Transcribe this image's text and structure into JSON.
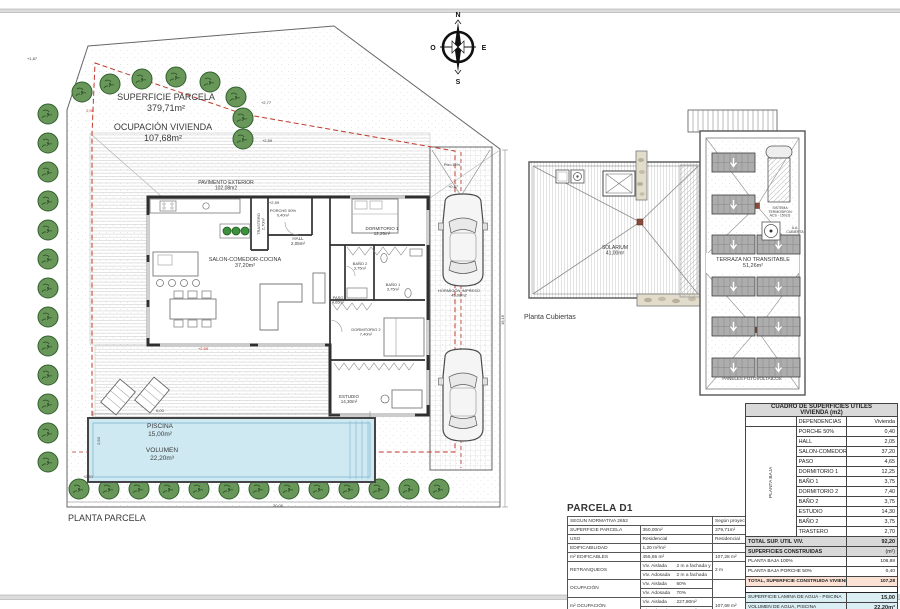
{
  "sheet_title": "PLANTA PARCELA",
  "compass": {
    "n": "N",
    "s": "S",
    "e": "E",
    "o": "O"
  },
  "labels": [
    {
      "x": 166,
      "y": 100,
      "s": 9,
      "lh": 11,
      "lines": [
        "SUPERFICIE PARCELA",
        "379,71m²"
      ]
    },
    {
      "x": 163,
      "y": 130,
      "s": 9,
      "lh": 11,
      "lines": [
        "OCUPACIÓN VIVIENDA",
        "107,68m²"
      ]
    },
    {
      "x": 226,
      "y": 184,
      "s": 5,
      "lh": 5.5,
      "lines": [
        "PAVIMENTO EXTERIOR",
        "102,08m2"
      ]
    },
    {
      "x": 260,
      "y": 224,
      "s": 4,
      "lh": 4.5,
      "rot": -90,
      "lines": [
        "TRASTERO",
        "2,70m²"
      ]
    },
    {
      "x": 283,
      "y": 212,
      "s": 4,
      "lh": 4.5,
      "lines": [
        "PORCHE 50%",
        "0,40m²"
      ]
    },
    {
      "x": 298,
      "y": 240,
      "s": 4.5,
      "lh": 5,
      "lines": [
        "HALL",
        "2,05m²"
      ]
    },
    {
      "x": 245,
      "y": 261,
      "s": 5.5,
      "lh": 6,
      "lines": [
        "SALON-COMEDOR-COCINA",
        "37,20m²"
      ]
    },
    {
      "x": 382,
      "y": 230,
      "s": 4.5,
      "lh": 5,
      "lines": [
        "DORMITORIO 1",
        "12,25m²"
      ]
    },
    {
      "x": 360,
      "y": 265,
      "s": 4,
      "lh": 4.5,
      "lines": [
        "BAÑO 2",
        "3,75m²"
      ]
    },
    {
      "x": 393,
      "y": 286,
      "s": 4,
      "lh": 4.5,
      "lines": [
        "BAÑO 1",
        "3,75m²"
      ]
    },
    {
      "x": 338,
      "y": 299,
      "s": 4,
      "lh": 4.5,
      "lines": [
        "PASO",
        "4,65m²"
      ]
    },
    {
      "x": 366,
      "y": 331,
      "s": 4,
      "lh": 4.5,
      "lines": [
        "DORMITORIO 2",
        "7,40m²"
      ]
    },
    {
      "x": 349,
      "y": 398,
      "s": 4.5,
      "lh": 5,
      "lines": [
        "ESTUDIO",
        "14,30m²"
      ]
    },
    {
      "x": 459,
      "y": 292,
      "s": 4,
      "lh": 4.5,
      "lines": [
        "HORMIGÓN IMPRESO",
        "45,08m2"
      ]
    },
    {
      "x": 160,
      "y": 428,
      "s": 6.5,
      "lh": 8,
      "lines": [
        "PISCINA",
        "15,00m²"
      ]
    },
    {
      "x": 162,
      "y": 452,
      "s": 6.5,
      "lh": 8,
      "lines": [
        "VOLUMEN",
        "22,20m³"
      ]
    },
    {
      "x": 615,
      "y": 249,
      "s": 5,
      "lh": 5.5,
      "lines": [
        "SOLARIUM",
        "41,00m²"
      ]
    },
    {
      "x": 753,
      "y": 261,
      "s": 5.5,
      "lh": 6,
      "lines": [
        "TERRAZA NO TRANSITABLE",
        "51,26m²"
      ]
    },
    {
      "x": 752,
      "y": 380,
      "s": 4.5,
      "lh": 5,
      "lines": [
        "PANELES  FOTOVOLTAICOS"
      ]
    },
    {
      "x": 780,
      "y": 209,
      "s": 3.5,
      "lh": 3.8,
      "lines": [
        "SISTEMA",
        "TERMOSIFON",
        "ACS - 150Lts"
      ]
    },
    {
      "x": 795,
      "y": 229,
      "s": 3.5,
      "lh": 3.8,
      "lines": [
        "A.A.",
        "CUBIERTA"
      ]
    },
    {
      "x": 524,
      "y": 319,
      "s": 7,
      "anchor": "start",
      "lines": [
        "Planta Cubiertas"
      ]
    },
    {
      "x": 68,
      "y": 521,
      "s": 9,
      "anchor": "start",
      "lines": [
        "PLANTA PARCELA"
      ]
    }
  ],
  "dims": [
    {
      "x": 32,
      "y": 60,
      "t": "+1,87"
    },
    {
      "x": 90,
      "y": 112,
      "t": "2,98",
      "c": "#c0392b"
    },
    {
      "x": 266,
      "y": 104,
      "t": "+2,77"
    },
    {
      "x": 267,
      "y": 142,
      "t": "+2,59"
    },
    {
      "x": 274,
      "y": 204,
      "t": "+2,59"
    },
    {
      "x": 452,
      "y": 166,
      "t": "Pte=16%"
    },
    {
      "x": 453,
      "y": 188,
      "t": "+0,87"
    },
    {
      "x": 203,
      "y": 350,
      "t": "+2,59",
      "c": "#c0392b"
    },
    {
      "x": 160,
      "y": 412,
      "t": "6,00"
    },
    {
      "x": 100,
      "y": 441,
      "t": "2,50",
      "rot": -90
    },
    {
      "x": 88,
      "y": 478,
      "t": "+2,51"
    },
    {
      "x": 278,
      "y": 507,
      "t": "20,00"
    },
    {
      "x": 504,
      "y": 320,
      "t": "16,16",
      "rot": -90
    }
  ],
  "parcela_table": {
    "title": "PARCELA D1",
    "header_left": "SEGUN NORMATIVA 2652",
    "header_right": "Según proyecto",
    "rows": [
      {
        "label": "SUPERFICIE PARCELA",
        "cells": [
          [
            "350,00m²",
            ""
          ]
        ],
        "right": "379,71m²"
      },
      {
        "label": "USO",
        "cells": [
          [
            "Residencial",
            ""
          ]
        ],
        "right": "Residencial"
      },
      {
        "label": "EDIFICABILIDAD",
        "cells": [
          [
            "1,20 m²/m²",
            ""
          ]
        ],
        "right": ""
      },
      {
        "label": "m² EDIFICABLES",
        "cells": [
          [
            "455,65 m²",
            ""
          ]
        ],
        "right": "107,28 m²"
      },
      {
        "label": "RETRANQUEOS",
        "cells": [
          [
            "Viv. Aislada",
            "2 m a fachada y lindes"
          ],
          [
            "Viv. Adosada",
            "2 m a fachada"
          ]
        ],
        "right": "2 m"
      },
      {
        "label": "OCUPACIÓN",
        "cells": [
          [
            "Viv. Aislada",
            "60%"
          ],
          [
            "Viv. Adosada",
            "70%"
          ]
        ],
        "right": ""
      },
      {
        "label": "m² OCUPACIÓN",
        "cells": [
          [
            "Viv. Aislada",
            "227,80m²"
          ],
          [
            "Viv. Adosada",
            "265,80m²"
          ]
        ],
        "right": "107,68 m²"
      }
    ]
  },
  "cuadro": {
    "title_line1": "CUADRO DE SUPERFICIES UTILES",
    "title_line2": "VIVIENDA (m2)",
    "col_dependencias": "DEPENDENCIAS",
    "col_vivienda": "Vivienda",
    "planta_label": "PLANTA BAJA",
    "rows": [
      [
        "PORCHE 50%",
        "0,40"
      ],
      [
        "HALL",
        "2,05"
      ],
      [
        "SALON-COMEDOR-COCINA",
        "37,20"
      ],
      [
        "PASO",
        "4,65"
      ],
      [
        "DORMITORIO 1",
        "12,25"
      ],
      [
        "BAÑO 1",
        "3,75"
      ],
      [
        "DORMITORIO 2",
        "7,40"
      ],
      [
        "BAÑO 2",
        "3,75"
      ],
      [
        "ESTUDIO",
        "14,30"
      ],
      [
        "BAÑO 2",
        "3,75"
      ],
      [
        "TRASTERO",
        "2,70"
      ]
    ],
    "total_label": "TOTAL SUP. UTIL VIV.",
    "total_value": "92,20",
    "construidas_title": "SUPERFICIES CONSTRUIDAS",
    "construidas_unit": "(m²)",
    "construidas_rows": [
      [
        "PLANTA BAJA 100%",
        "106,88"
      ],
      [
        "PLANTA BAJA PORCHE 50%",
        "0,40"
      ]
    ],
    "construidas_total_label": "TOTAL, SUPERFICIE CONSTRUIDA VIVIENDA",
    "construidas_total_value": "107,28",
    "agua_rows": [
      [
        "SUPERFICIE LAMINA DE AGUA - PISCINA",
        "15,00"
      ],
      [
        "VOLUMEN DE AGUA, PISCINA",
        "22,20m³"
      ]
    ]
  },
  "colors": {
    "boundary_red": "#c0392b",
    "pool_water": "#cfe9f2",
    "tree_green": "#69975a",
    "total_orange": "#fbe2d5",
    "agua_blue": "#daeef3",
    "header_gray": "#d9d9d9"
  }
}
